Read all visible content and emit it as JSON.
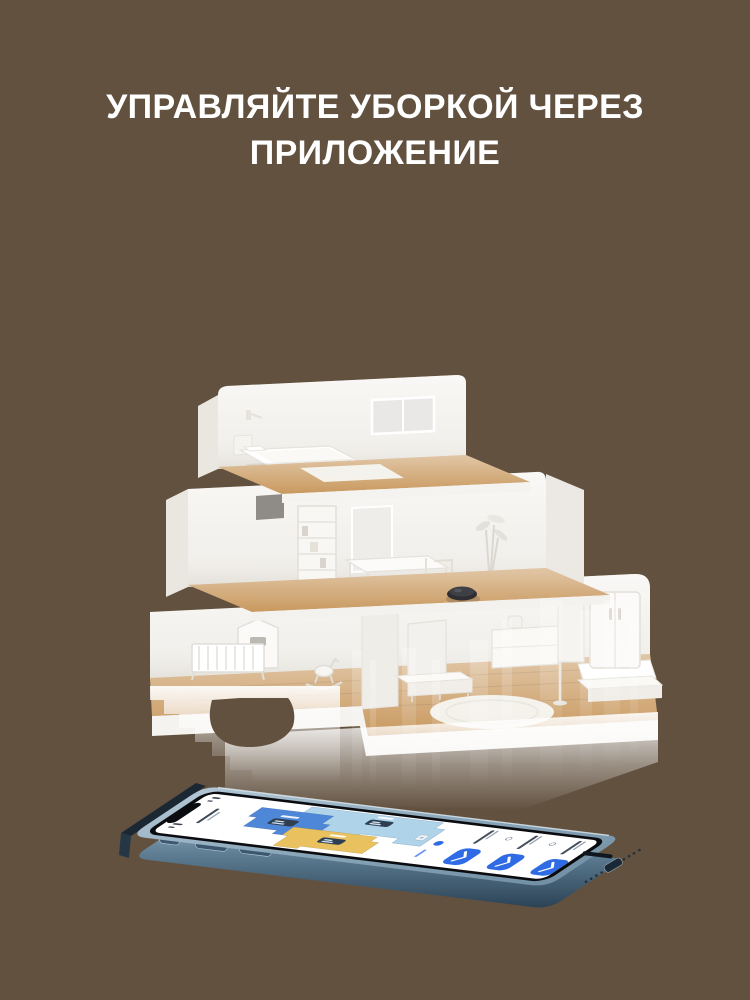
{
  "page": {
    "background_color": "#62513F"
  },
  "heading": {
    "line1": "УПРАВЛЯЙТЕ УБОРКОЙ ЧЕРЕЗ",
    "line2": "ПРИЛОЖЕНИЕ",
    "text_color": "#FFFFFF"
  },
  "house": {
    "wall_color": "#F3F1ED",
    "wall_side_color": "#EAE7E1",
    "floor_wood_color": "#C9995F",
    "rug_color": "#F6F5F1",
    "robot_vacuum_color": "#2E2E33"
  },
  "phone": {
    "bezel_color": "#0A0C0F",
    "screen_color": "#FFFFFF",
    "app": {
      "room_color_large": "#AFD4EA",
      "room_color_left": "#4E86D8",
      "room_color_bottom": "#E9C25F",
      "room_badge_color": "#2E3F52",
      "action_button_color": "#2F6BE4",
      "action_button_count": 3
    }
  }
}
